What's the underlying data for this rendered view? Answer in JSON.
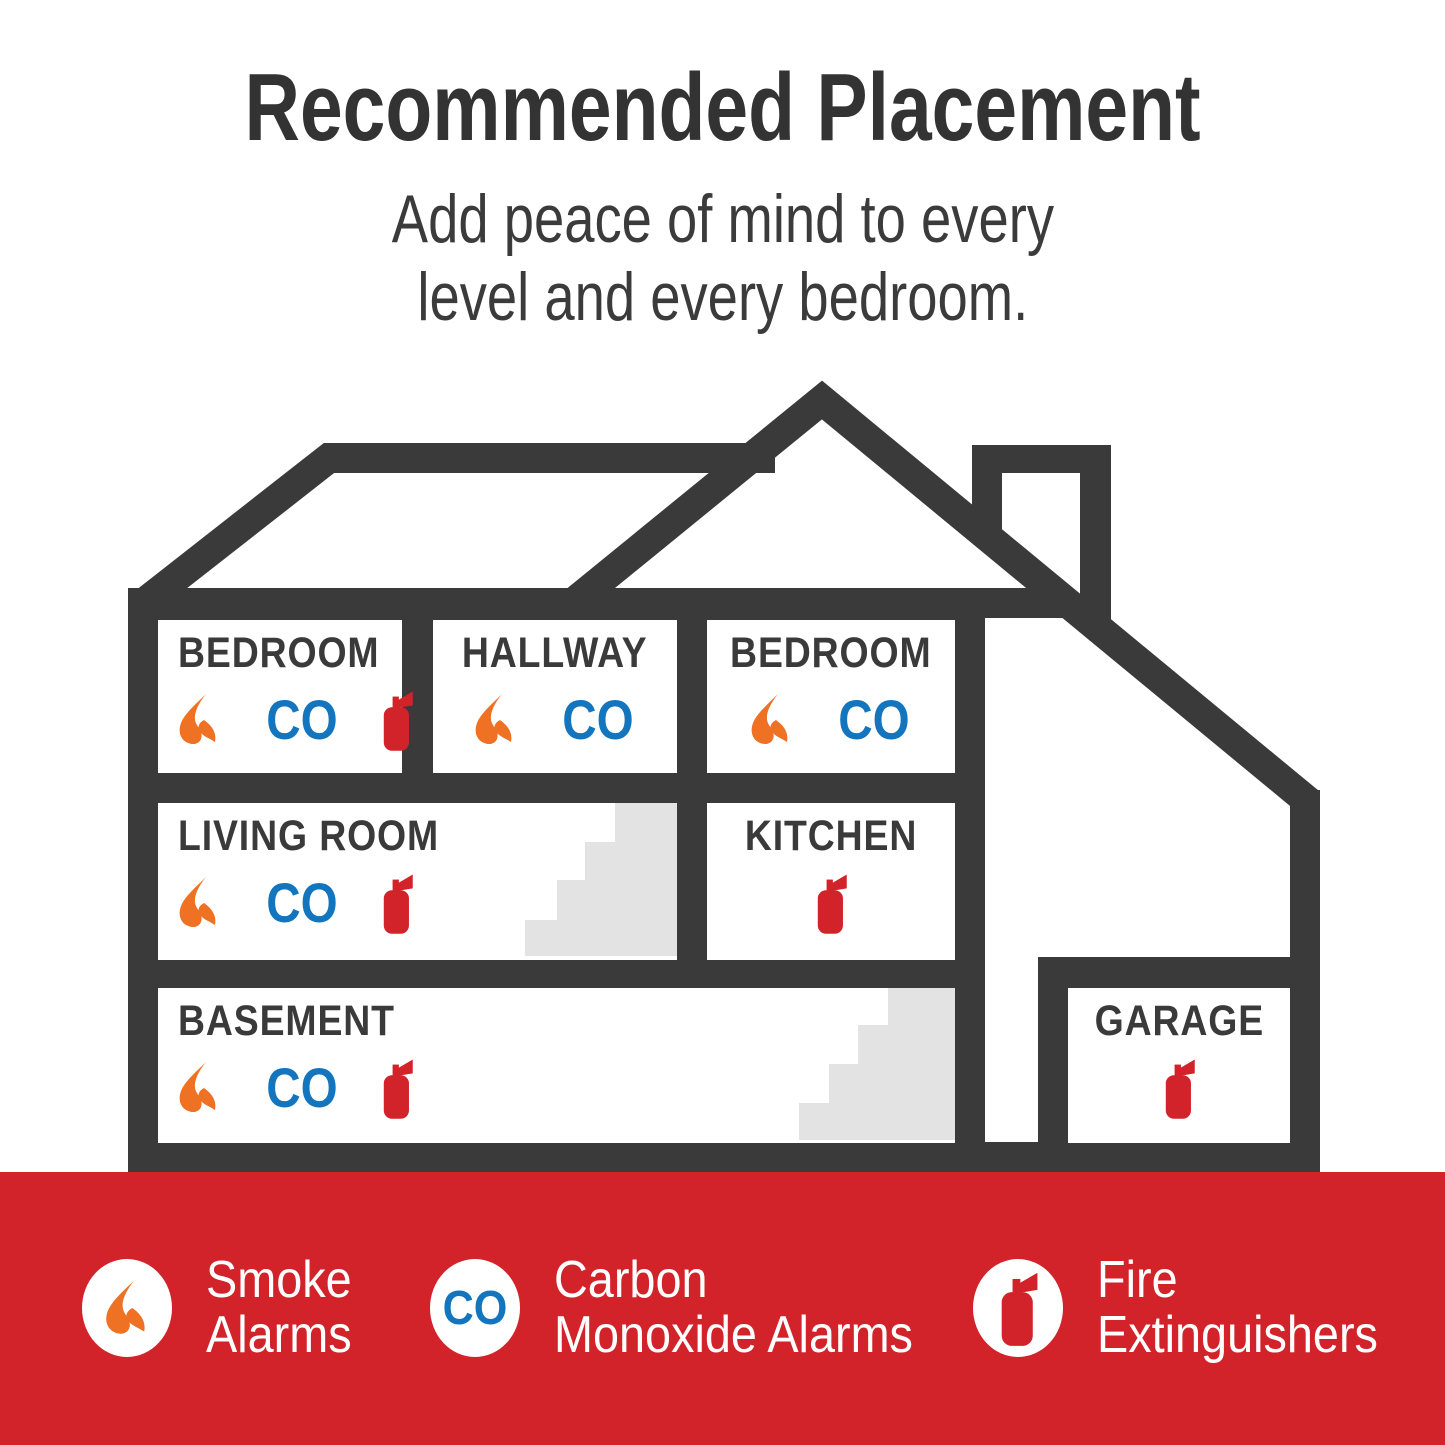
{
  "header": {
    "title": "Recommended Placement",
    "subtitle_line1": "Add peace of mind to every",
    "subtitle_line2": "level and every bedroom."
  },
  "house": {
    "co_label": "CO",
    "rooms": [
      {
        "id": "bedroom-1",
        "label": "BEDROOM",
        "align": "left",
        "icons": [
          "smoke",
          "co",
          "extinguisher"
        ]
      },
      {
        "id": "hallway",
        "label": "HALLWAY",
        "align": "center",
        "icons": [
          "smoke",
          "co"
        ]
      },
      {
        "id": "bedroom-2",
        "label": "BEDROOM",
        "align": "center",
        "icons": [
          "smoke",
          "co"
        ]
      },
      {
        "id": "living-room",
        "label": "LIVING ROOM",
        "align": "left",
        "icons": [
          "smoke",
          "co",
          "extinguisher"
        ]
      },
      {
        "id": "kitchen",
        "label": "KITCHEN",
        "align": "center",
        "icons": [
          "extinguisher"
        ]
      },
      {
        "id": "basement",
        "label": "BASEMENT",
        "align": "left",
        "icons": [
          "smoke",
          "co",
          "extinguisher"
        ]
      },
      {
        "id": "garage",
        "label": "GARAGE",
        "align": "center",
        "icons": [
          "extinguisher"
        ]
      }
    ]
  },
  "footer": {
    "items": [
      {
        "id": "smoke",
        "icon": "smoke",
        "label_line1": "Smoke",
        "label_line2": "Alarms"
      },
      {
        "id": "co",
        "icon": "co",
        "label_line1": "Carbon",
        "label_line2": "Monoxide Alarms"
      },
      {
        "id": "extinguisher",
        "icon": "extinguisher",
        "label_line1": "Fire",
        "label_line2": "Extinguishers"
      }
    ]
  },
  "colors": {
    "structure_gray": "#3a3a3a",
    "accent_red": "#d2232a",
    "flame_orange": "#ee7124",
    "co_blue": "#1375bd",
    "stairs_gray": "#e3e3e3"
  }
}
